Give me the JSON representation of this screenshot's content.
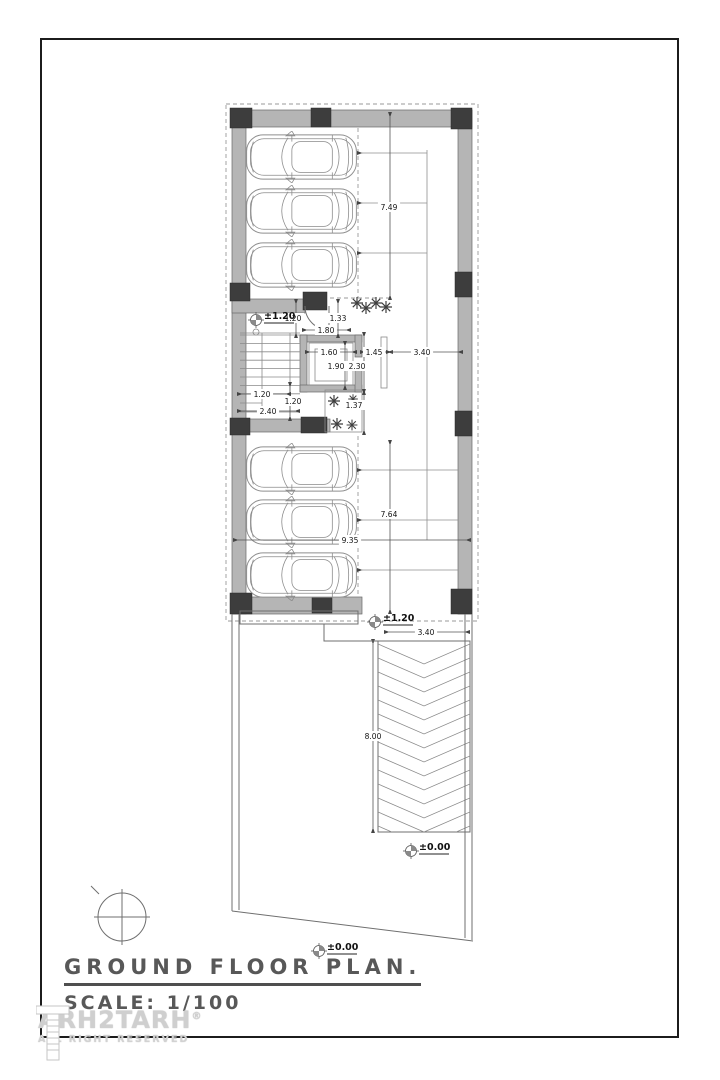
{
  "title_block": {
    "title": "GROUND FLOOR PLAN.",
    "scale": "SCALE: 1/100"
  },
  "watermark": {
    "brand": "ARH2TARH",
    "registered": "®",
    "tagline": "ALL RIGHT RESERVED"
  },
  "plan": {
    "dimensions": [
      {
        "t": "7.49",
        "x": 389,
        "y": 207
      },
      {
        "t": "1.20",
        "x": 293,
        "y": 318
      },
      {
        "t": "1.33",
        "x": 338,
        "y": 318
      },
      {
        "t": "1.80",
        "x": 326,
        "y": 330
      },
      {
        "t": "1.60",
        "x": 329,
        "y": 352
      },
      {
        "t": "1.45",
        "x": 374,
        "y": 352
      },
      {
        "t": "3.40",
        "x": 422,
        "y": 352
      },
      {
        "t": "1.90",
        "x": 336,
        "y": 366
      },
      {
        "t": "2.30",
        "x": 357,
        "y": 366
      },
      {
        "t": "1.20",
        "x": 262,
        "y": 394
      },
      {
        "t": "1.20",
        "x": 293,
        "y": 401
      },
      {
        "t": "1.37",
        "x": 354,
        "y": 405
      },
      {
        "t": "2.40",
        "x": 268,
        "y": 411
      },
      {
        "t": "7.64",
        "x": 389,
        "y": 514
      },
      {
        "t": "9.35",
        "x": 350,
        "y": 540
      },
      {
        "t": "3.40",
        "x": 426,
        "y": 632
      },
      {
        "t": "8.00",
        "x": 373,
        "y": 736
      }
    ],
    "levels": [
      {
        "label": "±1.20",
        "icon_x": 256,
        "icon_y": 320,
        "text_x": 264,
        "text_y": 316
      },
      {
        "label": "±1.20",
        "icon_x": 375,
        "icon_y": 622,
        "text_x": 383,
        "text_y": 618
      },
      {
        "label": "±0.00",
        "icon_x": 411,
        "icon_y": 851,
        "text_x": 419,
        "text_y": 847
      },
      {
        "label": "±0.00",
        "icon_x": 319,
        "icon_y": 951,
        "text_x": 327,
        "text_y": 947
      }
    ],
    "ramp": {
      "left": 378,
      "top": 641,
      "right": 470,
      "bottom": 832,
      "step": 14,
      "depth": 20
    }
  },
  "colors": {
    "wall": "#b5b5b5",
    "column": "#3d3d3d",
    "linework": "#6f6f6f",
    "dimension": "#555555",
    "title": "#585858",
    "watermark": "#cfcfcf"
  }
}
